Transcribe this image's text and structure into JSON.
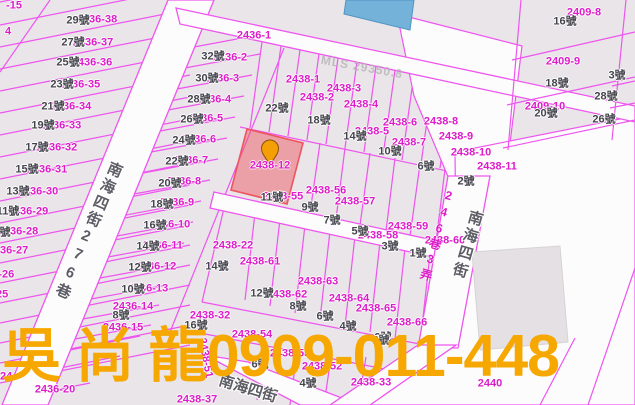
{
  "map": {
    "highlight": {
      "parcel_id": "2438-12"
    },
    "agent_overlay": {
      "text": "吳 尚 龍0909-011-448",
      "color": "#F6A800"
    },
    "labels": [
      {
        "t": "-15",
        "x": 14,
        "y": 6,
        "k": "parcel"
      },
      {
        "t": "4",
        "x": 8,
        "y": 32,
        "k": "parcel"
      },
      {
        "t": "2436-38",
        "x": 97,
        "y": 20,
        "k": "parcel"
      },
      {
        "t": "2436-37",
        "x": 93,
        "y": 43,
        "k": "parcel"
      },
      {
        "t": "2436-36",
        "x": 92,
        "y": 63,
        "k": "parcel"
      },
      {
        "t": "2436-35",
        "x": 80,
        "y": 85,
        "k": "parcel"
      },
      {
        "t": "2436-34",
        "x": 71,
        "y": 107,
        "k": "parcel"
      },
      {
        "t": "2436-33",
        "x": 61,
        "y": 126,
        "k": "parcel"
      },
      {
        "t": "2436-32",
        "x": 57,
        "y": 148,
        "k": "parcel"
      },
      {
        "t": "2436-31",
        "x": 47,
        "y": 170,
        "k": "parcel"
      },
      {
        "t": "2436-30",
        "x": 38,
        "y": 192,
        "k": "parcel"
      },
      {
        "t": "2436-29",
        "x": 28,
        "y": 212,
        "k": "parcel"
      },
      {
        "t": "2436-28",
        "x": 18,
        "y": 232,
        "k": "parcel"
      },
      {
        "t": "2436-27",
        "x": 8,
        "y": 251,
        "k": "parcel"
      },
      {
        "t": "2436-26",
        "x": -6,
        "y": 275,
        "k": "parcel"
      },
      {
        "t": "2436-25",
        "x": -12,
        "y": 295,
        "k": "parcel"
      },
      {
        "t": "2436-24",
        "x": -8,
        "y": 377,
        "k": "parcel"
      },
      {
        "t": "29號",
        "x": 78,
        "y": 21,
        "k": "house"
      },
      {
        "t": "27號",
        "x": 73,
        "y": 43,
        "k": "house"
      },
      {
        "t": "25號",
        "x": 68,
        "y": 63,
        "k": "house"
      },
      {
        "t": "23號",
        "x": 62,
        "y": 85,
        "k": "house"
      },
      {
        "t": "21號",
        "x": 53,
        "y": 107,
        "k": "house"
      },
      {
        "t": "19號",
        "x": 43,
        "y": 126,
        "k": "house"
      },
      {
        "t": "17號",
        "x": 37,
        "y": 148,
        "k": "house"
      },
      {
        "t": "15號",
        "x": 27,
        "y": 170,
        "k": "house"
      },
      {
        "t": "13號",
        "x": 18,
        "y": 192,
        "k": "house"
      },
      {
        "t": "11號",
        "x": 8,
        "y": 212,
        "k": "house"
      },
      {
        "t": "9號",
        "x": 2,
        "y": 233,
        "k": "house"
      },
      {
        "t": "2436-1",
        "x": 254,
        "y": 36,
        "k": "parcel"
      },
      {
        "t": "2436-2",
        "x": 230,
        "y": 58,
        "k": "parcel"
      },
      {
        "t": "2436-3",
        "x": 222,
        "y": 79,
        "k": "parcel"
      },
      {
        "t": "2436-4",
        "x": 214,
        "y": 100,
        "k": "parcel"
      },
      {
        "t": "2436-5",
        "x": 206,
        "y": 119,
        "k": "parcel"
      },
      {
        "t": "2436-6",
        "x": 199,
        "y": 140,
        "k": "parcel"
      },
      {
        "t": "2436-7",
        "x": 191,
        "y": 161,
        "k": "parcel"
      },
      {
        "t": "2436-8",
        "x": 184,
        "y": 182,
        "k": "parcel"
      },
      {
        "t": "2436-9",
        "x": 177,
        "y": 203,
        "k": "parcel"
      },
      {
        "t": "2436-10",
        "x": 170,
        "y": 225,
        "k": "parcel"
      },
      {
        "t": "2436-11",
        "x": 163,
        "y": 246,
        "k": "parcel"
      },
      {
        "t": "2436-12",
        "x": 156,
        "y": 267,
        "k": "parcel"
      },
      {
        "t": "2436-13",
        "x": 148,
        "y": 289,
        "k": "parcel"
      },
      {
        "t": "2436-14",
        "x": 133,
        "y": 307,
        "k": "parcel"
      },
      {
        "t": "2436-15",
        "x": 123,
        "y": 328,
        "k": "parcel"
      },
      {
        "t": "2436-20",
        "x": 55,
        "y": 390,
        "k": "parcel"
      },
      {
        "t": "32號",
        "x": 213,
        "y": 57,
        "k": "house"
      },
      {
        "t": "30號",
        "x": 207,
        "y": 79,
        "k": "house"
      },
      {
        "t": "28號",
        "x": 199,
        "y": 100,
        "k": "house"
      },
      {
        "t": "26號",
        "x": 192,
        "y": 120,
        "k": "house"
      },
      {
        "t": "24號",
        "x": 184,
        "y": 141,
        "k": "house"
      },
      {
        "t": "22號",
        "x": 177,
        "y": 162,
        "k": "house"
      },
      {
        "t": "20號",
        "x": 170,
        "y": 184,
        "k": "house"
      },
      {
        "t": "18號",
        "x": 162,
        "y": 205,
        "k": "house"
      },
      {
        "t": "16號",
        "x": 155,
        "y": 226,
        "k": "house"
      },
      {
        "t": "14號",
        "x": 148,
        "y": 247,
        "k": "house"
      },
      {
        "t": "12號",
        "x": 140,
        "y": 268,
        "k": "house"
      },
      {
        "t": "10號",
        "x": 133,
        "y": 290,
        "k": "house"
      },
      {
        "t": "8號",
        "x": 121,
        "y": 316,
        "k": "house"
      },
      {
        "t": "2438-1",
        "x": 303,
        "y": 80,
        "k": "parcel"
      },
      {
        "t": "2438-2",
        "x": 317,
        "y": 98,
        "k": "parcel"
      },
      {
        "t": "2438-3",
        "x": 344,
        "y": 89,
        "k": "parcel"
      },
      {
        "t": "2438-4",
        "x": 361,
        "y": 105,
        "k": "parcel"
      },
      {
        "t": "2438-5",
        "x": 372,
        "y": 132,
        "k": "parcel"
      },
      {
        "t": "2438-6",
        "x": 400,
        "y": 123,
        "k": "parcel"
      },
      {
        "t": "2438-7",
        "x": 409,
        "y": 143,
        "k": "parcel"
      },
      {
        "t": "2438-8",
        "x": 441,
        "y": 122,
        "k": "parcel"
      },
      {
        "t": "2438-9",
        "x": 456,
        "y": 137,
        "k": "parcel"
      },
      {
        "t": "2438-10",
        "x": 471,
        "y": 153,
        "k": "parcel"
      },
      {
        "t": "2438-11",
        "x": 497,
        "y": 167,
        "k": "parcel"
      },
      {
        "t": "2438-12",
        "x": 270,
        "y": 166,
        "k": "parcel"
      },
      {
        "t": "22號",
        "x": 277,
        "y": 109,
        "k": "house"
      },
      {
        "t": "18號",
        "x": 319,
        "y": 121,
        "k": "house"
      },
      {
        "t": "14號",
        "x": 355,
        "y": 137,
        "k": "house"
      },
      {
        "t": "10號",
        "x": 390,
        "y": 152,
        "k": "house"
      },
      {
        "t": "6號",
        "x": 426,
        "y": 167,
        "k": "house"
      },
      {
        "t": "2號",
        "x": 466,
        "y": 182,
        "k": "house"
      },
      {
        "t": "2409-8",
        "x": 584,
        "y": 13,
        "k": "parcel"
      },
      {
        "t": "2409-9",
        "x": 563,
        "y": 62,
        "k": "parcel"
      },
      {
        "t": "2409-10",
        "x": 545,
        "y": 107,
        "k": "parcel"
      },
      {
        "t": "16號",
        "x": 565,
        "y": 22,
        "k": "house"
      },
      {
        "t": "18號",
        "x": 557,
        "y": 84,
        "k": "house"
      },
      {
        "t": "20號",
        "x": 546,
        "y": 114,
        "k": "house"
      },
      {
        "t": "3號",
        "x": 617,
        "y": 76,
        "k": "house"
      },
      {
        "t": "28號",
        "x": 606,
        "y": 97,
        "k": "house"
      },
      {
        "t": "26號",
        "x": 604,
        "y": 120,
        "k": "house"
      },
      {
        "t": "2438-55",
        "x": 283,
        "y": 197,
        "k": "parcel"
      },
      {
        "t": "2438-56",
        "x": 326,
        "y": 191,
        "k": "parcel"
      },
      {
        "t": "2438-57",
        "x": 355,
        "y": 202,
        "k": "parcel"
      },
      {
        "t": "2438-58",
        "x": 378,
        "y": 236,
        "k": "parcel"
      },
      {
        "t": "2438-59",
        "x": 408,
        "y": 227,
        "k": "parcel"
      },
      {
        "t": "2438-60",
        "x": 445,
        "y": 241,
        "k": "parcel"
      },
      {
        "t": "11號",
        "x": 272,
        "y": 198,
        "k": "house"
      },
      {
        "t": "9號",
        "x": 310,
        "y": 208,
        "k": "house"
      },
      {
        "t": "7號",
        "x": 332,
        "y": 221,
        "k": "house"
      },
      {
        "t": "5號",
        "x": 360,
        "y": 232,
        "k": "house"
      },
      {
        "t": "3號",
        "x": 390,
        "y": 247,
        "k": "house"
      },
      {
        "t": "1號",
        "x": 418,
        "y": 254,
        "k": "house"
      },
      {
        "t": "2438-22",
        "x": 233,
        "y": 246,
        "k": "parcel"
      },
      {
        "t": "2438-61",
        "x": 260,
        "y": 262,
        "k": "parcel"
      },
      {
        "t": "2438-62",
        "x": 287,
        "y": 295,
        "k": "parcel"
      },
      {
        "t": "2438-63",
        "x": 318,
        "y": 282,
        "k": "parcel"
      },
      {
        "t": "2438-64",
        "x": 349,
        "y": 299,
        "k": "parcel"
      },
      {
        "t": "2438-65",
        "x": 376,
        "y": 309,
        "k": "parcel"
      },
      {
        "t": "2438-66",
        "x": 407,
        "y": 323,
        "k": "parcel"
      },
      {
        "t": "14號",
        "x": 217,
        "y": 267,
        "k": "house"
      },
      {
        "t": "16號",
        "x": 196,
        "y": 326,
        "k": "house"
      },
      {
        "t": "12號",
        "x": 262,
        "y": 294,
        "k": "house"
      },
      {
        "t": "8號",
        "x": 298,
        "y": 307,
        "k": "house"
      },
      {
        "t": "6號",
        "x": 325,
        "y": 317,
        "k": "house"
      },
      {
        "t": "4號",
        "x": 348,
        "y": 327,
        "k": "house"
      },
      {
        "t": "2號",
        "x": 383,
        "y": 338,
        "k": "house"
      },
      {
        "t": "2438-32",
        "x": 210,
        "y": 316,
        "k": "parcel"
      },
      {
        "t": "2438-54",
        "x": 252,
        "y": 335,
        "k": "parcel"
      },
      {
        "t": "2438-53",
        "x": 290,
        "y": 354,
        "k": "parcel"
      },
      {
        "t": "2438-52",
        "x": 322,
        "y": 367,
        "k": "parcel"
      },
      {
        "t": "2438-51",
        "x": 205,
        "y": 358,
        "k": "parcel",
        "r": 80
      },
      {
        "t": "2438-33",
        "x": 371,
        "y": 383,
        "k": "parcel"
      },
      {
        "t": "2438-37",
        "x": 197,
        "y": 400,
        "k": "parcel"
      },
      {
        "t": "2440",
        "x": 490,
        "y": 384,
        "k": "parcel"
      },
      {
        "t": "6號",
        "x": 260,
        "y": 365,
        "k": "house"
      },
      {
        "t": "4號",
        "x": 308,
        "y": 384,
        "k": "house"
      },
      {
        "t": "2號",
        "x": 381,
        "y": 341,
        "k": "house"
      },
      {
        "t": "南海四街276巷",
        "x": 88,
        "y": 231,
        "k": "street-v",
        "r": 23
      },
      {
        "t": "南海四街",
        "x": 467,
        "y": 245,
        "k": "street-v",
        "r": 16
      },
      {
        "t": "246巷3弄",
        "x": 437,
        "y": 236,
        "k": "lane-v",
        "r": 16
      },
      {
        "t": "南海四街",
        "x": 248,
        "y": 389,
        "k": "street-h",
        "r": 17
      },
      {
        "t": "MLS 29350.8",
        "x": 362,
        "y": 67,
        "k": "watermark",
        "r": 10
      }
    ]
  },
  "colors": {
    "parcel_line": "#ee55ee",
    "parcel_label": "#dd1cc9",
    "house_label": "#43434b",
    "highlight_fill": "rgba(236,92,100,0.5)",
    "highlight_stroke": "#ef5560",
    "pin": "#F49F06",
    "building_blue": "#74b2da",
    "overlay_orange": "#F6A800",
    "background": "#e9e5e9",
    "road": "#fdfcfd"
  }
}
